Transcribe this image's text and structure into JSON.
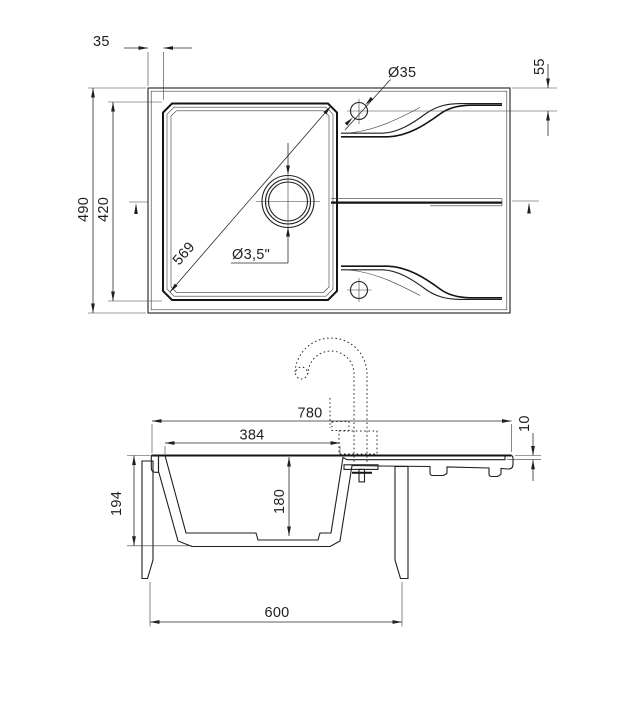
{
  "drawing": {
    "subject": "Granite kitchen sink with single bowl and drainer board — dimensioned technical drawing",
    "units": "mm",
    "colors": {
      "background": "#ffffff",
      "line": "#1f1f1f"
    },
    "views": {
      "top": {
        "label": "plan view",
        "dims": {
          "rim_offset": "35",
          "tap_hole_dia": "Ø35",
          "tap_hole_from_edge": "55",
          "overall_depth": "490",
          "bowl_depth": "420",
          "bowl_diagonal": "569",
          "drain_dia": "Ø3,5\""
        }
      },
      "section": {
        "label": "front section view",
        "dims": {
          "overall_width": "780",
          "bowl_width": "384",
          "drainer_recess": "10",
          "sink_height": "194",
          "bowl_height": "180",
          "cabinet_width": "600"
        }
      }
    }
  }
}
